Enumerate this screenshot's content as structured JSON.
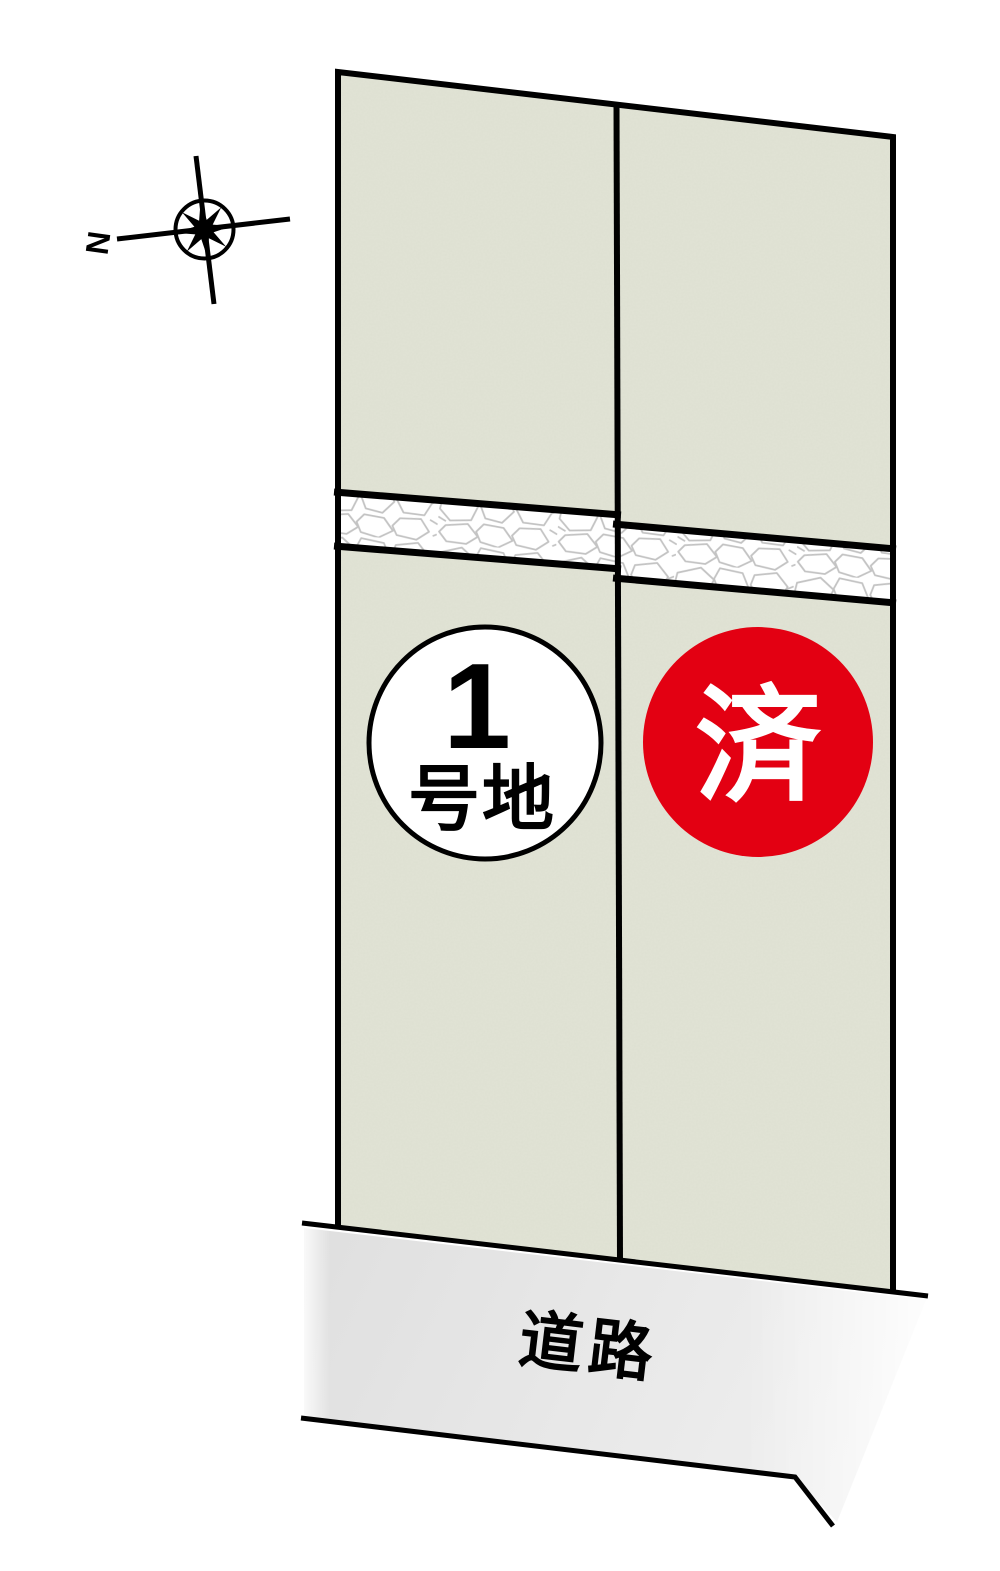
{
  "compass": {
    "north_label": "N"
  },
  "lots": {
    "lot1": {
      "number": "1",
      "suffix": "号地"
    },
    "lot2": {
      "status_label": "済"
    }
  },
  "road": {
    "label": "道路"
  },
  "colors": {
    "lot_fill": "#e1e3d5",
    "road_fill": "#e9e9e9",
    "sold_red": "#e30012",
    "badge_bg": "#ffffff",
    "line_black": "#000000",
    "stone_outline": "#c3c3c3"
  }
}
